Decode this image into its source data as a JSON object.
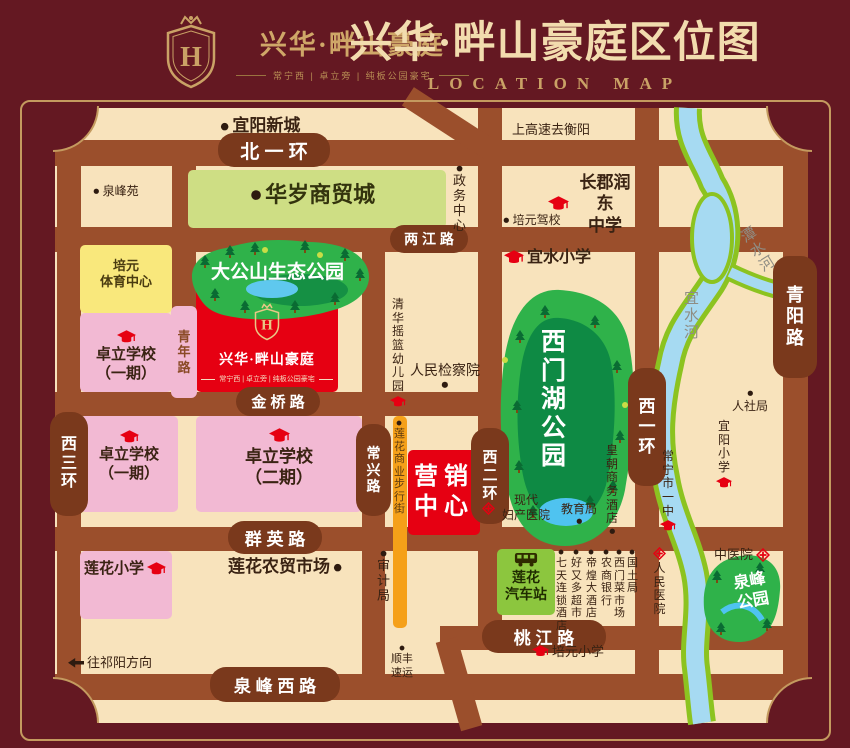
{
  "header": {
    "logo_name": "兴华·畔山豪庭",
    "logo_tagline": "常宁西 | 卓立旁 | 纯板公园豪宅",
    "title": "兴华·畔山豪庭区位图",
    "subtitle": "LOCATION MAP"
  },
  "colors": {
    "background_maroon": "#641822",
    "gold": "#c49a5f",
    "map_cream": "#f8e3bc",
    "road_brown": "#9b4f2c",
    "road_pill": "#7a391c",
    "school_pink": "#f2b9d3",
    "sports_yellow": "#f9e87c",
    "mall_green": "#cede84",
    "park_green": "#2fb24a",
    "park_dark_green": "#0e8a44",
    "river_blue": "#a6daf2",
    "bank_green": "#8cc320",
    "brand_red": "#e60012",
    "bus_green": "#8cc63e",
    "street_orange": "#f5a019"
  },
  "map": {
    "project": {
      "name": "兴华·畔山豪庭",
      "tagline": "常宁西 | 卓立旁 | 纯板公园豪宅"
    },
    "roads": [
      {
        "n": "beiyihuan",
        "x": 55,
        "y": 140,
        "w": 753,
        "h": 26
      },
      {
        "n": "liangjiang-rd",
        "x": 55,
        "y": 227,
        "w": 753,
        "h": 25
      },
      {
        "n": "jinqiao-rd",
        "x": 55,
        "y": 392,
        "w": 450,
        "h": 24
      },
      {
        "n": "qunying-rd",
        "x": 55,
        "y": 527,
        "w": 753,
        "h": 24
      },
      {
        "n": "taojiang-rd",
        "x": 440,
        "y": 626,
        "w": 368,
        "h": 24
      },
      {
        "n": "quanfeng-west-rd",
        "x": 55,
        "y": 674,
        "w": 753,
        "h": 26
      },
      {
        "n": "xisanhuan",
        "x": 57,
        "y": 108,
        "w": 24,
        "h": 615
      },
      {
        "n": "qingnian-rd",
        "x": 172,
        "y": 166,
        "w": 24,
        "h": 250
      },
      {
        "n": "changxing-rd",
        "x": 362,
        "y": 227,
        "w": 23,
        "h": 473
      },
      {
        "n": "xierhuan",
        "x": 478,
        "y": 108,
        "w": 24,
        "h": 522
      },
      {
        "n": "xiyihuan",
        "x": 635,
        "y": 108,
        "w": 24,
        "h": 592
      },
      {
        "n": "qingyang-rd",
        "x": 783,
        "y": 118,
        "w": 25,
        "h": 605
      },
      {
        "n": "xierhuan-ramp-top",
        "x": 400,
        "y": 112,
        "w": 98,
        "h": 22,
        "rot": 33
      },
      {
        "n": "xierhuan-ramp-bottom",
        "x": 448,
        "y": 638,
        "w": 22,
        "h": 92,
        "rot": -16
      }
    ],
    "road_labels": [
      {
        "n": "beiyihuan",
        "t": "北 一 环",
        "x": 218,
        "y": 133,
        "w": 112,
        "h": 34,
        "fs": 19
      },
      {
        "n": "liangjiang-rd",
        "t": "两 江 路",
        "x": 390,
        "y": 225,
        "w": 78,
        "h": 28,
        "fs": 14
      },
      {
        "n": "jinqiao-rd",
        "t": "金 桥 路",
        "x": 236,
        "y": 387,
        "w": 84,
        "h": 29,
        "fs": 15
      },
      {
        "n": "qunying-rd",
        "t": "群 英 路",
        "x": 228,
        "y": 521,
        "w": 94,
        "h": 33,
        "fs": 17
      },
      {
        "n": "taojiang-rd",
        "t": "桃 江 路",
        "x": 482,
        "y": 620,
        "w": 124,
        "h": 33,
        "fs": 17
      },
      {
        "n": "quanfeng-west-rd",
        "t": "泉 峰 西 路",
        "x": 210,
        "y": 667,
        "w": 130,
        "h": 35,
        "fs": 17
      },
      {
        "n": "xisanhuan",
        "t": "西三环",
        "x": 50,
        "y": 412,
        "w": 38,
        "h": 104,
        "fs": 16,
        "v": 1
      },
      {
        "n": "changxing-rd",
        "t": "常兴路",
        "x": 356,
        "y": 424,
        "w": 35,
        "h": 92,
        "fs": 14,
        "v": 1
      },
      {
        "n": "xierhuan",
        "t": "西二环",
        "x": 471,
        "y": 428,
        "w": 38,
        "h": 96,
        "fs": 15,
        "v": 1
      },
      {
        "n": "xiyihuan",
        "t": "西一环",
        "x": 628,
        "y": 368,
        "w": 38,
        "h": 118,
        "fs": 17,
        "v": 1
      },
      {
        "n": "qingyang-rd",
        "t": "青阳路",
        "x": 773,
        "y": 256,
        "w": 44,
        "h": 122,
        "fs": 18,
        "v": 1
      },
      {
        "n": "qingnian-rd",
        "t": "青年路",
        "x": 171,
        "y": 306,
        "w": 26,
        "h": 92,
        "fs": 13,
        "v": 1,
        "pink": 1
      }
    ],
    "blocks": [
      {
        "n": "huasui-mall",
        "x": 188,
        "y": 170,
        "w": 258,
        "h": 58,
        "bg": "#cede84"
      },
      {
        "n": "peiyuan-sports-center",
        "x": 80,
        "y": 245,
        "w": 92,
        "h": 68,
        "bg": "#f9e87c"
      },
      {
        "n": "zhuoli-school-1a",
        "x": 80,
        "y": 313,
        "w": 92,
        "h": 79,
        "bg": "#f2b9d3"
      },
      {
        "n": "zhuoli-school-1b",
        "x": 80,
        "y": 416,
        "w": 98,
        "h": 96,
        "bg": "#f2b9d3"
      },
      {
        "n": "zhuoli-school-2",
        "x": 196,
        "y": 416,
        "w": 166,
        "h": 96,
        "bg": "#f2b9d3"
      },
      {
        "n": "lianhua-primary",
        "x": 80,
        "y": 551,
        "w": 92,
        "h": 68,
        "bg": "#f2b9d3"
      },
      {
        "n": "project-site",
        "x": 196,
        "y": 262,
        "w": 142,
        "h": 130,
        "bg": "#e60012"
      },
      {
        "n": "sales-center",
        "x": 408,
        "y": 450,
        "w": 72,
        "h": 85,
        "bg": "#e60012"
      },
      {
        "n": "lianhua-bus-station",
        "x": 497,
        "y": 549,
        "w": 58,
        "h": 66,
        "bg": "#8cc63e"
      },
      {
        "n": "lianhua-walking-street",
        "x": 393,
        "y": 416,
        "w": 14,
        "h": 212,
        "bg": "#f5a019"
      }
    ],
    "pois": [
      {
        "n": "yiyang-new-town",
        "t": "宜阳新城",
        "x": 220,
        "y": 116,
        "fs": 17,
        "bold": 1,
        "icon": "dot",
        "ip": "left"
      },
      {
        "n": "highway-to-hengyang",
        "t": "上高速去衡阳",
        "x": 512,
        "y": 122,
        "fs": 13
      },
      {
        "n": "quanfengyuan",
        "t": "泉峰苑",
        "x": 93,
        "y": 184,
        "fs": 12,
        "icon": "dot",
        "ip": "left"
      },
      {
        "n": "government-center",
        "t": "政务中心",
        "x": 453,
        "y": 165,
        "fs": 13,
        "v": 1,
        "icon": "dot",
        "ip": "top"
      },
      {
        "n": "changjun-rundong-school",
        "lines": [
          "长郡润东",
          "中学"
        ],
        "x": 548,
        "y": 172,
        "w": 90,
        "fs": 17,
        "bold": 1,
        "icon": "cap",
        "ip": "left"
      },
      {
        "n": "peiyuan-driving-school",
        "t": "培元驾校",
        "x": 503,
        "y": 213,
        "fs": 12,
        "icon": "dot",
        "ip": "left"
      },
      {
        "n": "yishui-primary",
        "t": "宜水小学",
        "x": 504,
        "y": 248,
        "fs": 16,
        "bold": 1,
        "icon": "cap",
        "ip": "left"
      },
      {
        "n": "qinghua-cradle-kindergarten",
        "t": "清华摇篮幼儿园",
        "x": 390,
        "y": 298,
        "fs": 12,
        "v": 1,
        "icon": "cap",
        "ip": "bottom"
      },
      {
        "n": "peoples-procuratorate",
        "t": "人民检察院",
        "x": 410,
        "y": 362,
        "fs": 14,
        "icon": "dot",
        "ip": "bottom"
      },
      {
        "n": "tanshui-river-label",
        "t": "潭水河",
        "x": 737,
        "y": 228,
        "fs": 15,
        "v": 1,
        "rot": -32,
        "color": "#8f8d84"
      },
      {
        "n": "yishui-river-label",
        "t": "宜水河",
        "x": 684,
        "y": 290,
        "fs": 15,
        "v": 1,
        "color": "#8f8d84"
      },
      {
        "n": "social-security-bureau",
        "t": "人社局",
        "x": 732,
        "y": 390,
        "fs": 12,
        "icon": "dot",
        "ip": "top"
      },
      {
        "n": "yiyang-primary",
        "t": "宜阳小学",
        "x": 716,
        "y": 420,
        "fs": 12,
        "v": 1,
        "icon": "cap",
        "ip": "bottom"
      },
      {
        "n": "changning-no1-middle-school",
        "t": "常宁市一中",
        "x": 660,
        "y": 450,
        "fs": 12,
        "v": 1,
        "icon": "cap",
        "ip": "bottom"
      },
      {
        "n": "huangchao-business-hotel",
        "t": "皇朝商务酒店",
        "x": 606,
        "y": 444,
        "fs": 12,
        "v": 1,
        "icon": "dot",
        "ip": "bottom"
      },
      {
        "n": "modern-maternity-hospital",
        "lines": [
          "现代",
          "妇产医院"
        ],
        "x": 482,
        "y": 493,
        "w": 72,
        "fs": 12,
        "icon": "cross",
        "ip": "left"
      },
      {
        "n": "education-bureau",
        "t": "教育局",
        "x": 561,
        "y": 502,
        "fs": 12,
        "icon": "dot",
        "ip": "bottom"
      },
      {
        "n": "lianhua-walking-street-label",
        "t": "莲花商业步行街",
        "x": 394,
        "y": 420,
        "fs": 11,
        "v": 1,
        "icon": "dot",
        "ip": "top",
        "color": "#5c3a10"
      },
      {
        "n": "audit-bureau",
        "t": "审计局",
        "x": 377,
        "y": 550,
        "fs": 13,
        "v": 1,
        "icon": "dot",
        "ip": "top"
      },
      {
        "n": "lianhua-farmers-market",
        "t": "莲花农贸市场",
        "x": 228,
        "y": 557,
        "fs": 17,
        "bold": 1,
        "icon": "dot",
        "ip": "right"
      },
      {
        "n": "7days-inn",
        "t": "七天连锁酒店",
        "x": 556,
        "y": 549,
        "fs": 11,
        "v": 1,
        "icon": "dot",
        "ip": "top"
      },
      {
        "n": "haoyouduo-supermarket",
        "t": "好又多超市",
        "x": 571,
        "y": 549,
        "fs": 11,
        "v": 1,
        "icon": "dot",
        "ip": "top"
      },
      {
        "n": "dihuang-hotel",
        "t": "帝煌大酒店",
        "x": 586,
        "y": 549,
        "fs": 11,
        "v": 1,
        "icon": "dot",
        "ip": "top"
      },
      {
        "n": "rural-commercial-bank",
        "t": "农商银行",
        "x": 601,
        "y": 549,
        "fs": 11,
        "v": 1,
        "icon": "dot",
        "ip": "top"
      },
      {
        "n": "ximen-food-market",
        "t": "西门菜市场",
        "x": 614,
        "y": 549,
        "fs": 11,
        "v": 1,
        "icon": "dot",
        "ip": "top"
      },
      {
        "n": "land-resources-bureau",
        "t": "国土局",
        "x": 627,
        "y": 549,
        "fs": 11,
        "v": 1,
        "icon": "dot",
        "ip": "top"
      },
      {
        "n": "tcm-hospital",
        "t": "中医院",
        "x": 714,
        "y": 547,
        "fs": 13,
        "icon": "cross",
        "ip": "right"
      },
      {
        "n": "peoples-hospital",
        "t": "人民医院",
        "x": 653,
        "y": 547,
        "fs": 12,
        "v": 1,
        "icon": "cross",
        "ip": "top"
      },
      {
        "n": "sf-express",
        "lines": [
          "顺丰",
          "速运"
        ],
        "x": 382,
        "y": 645,
        "w": 40,
        "fs": 11,
        "icon": "dot",
        "ip": "top"
      },
      {
        "n": "to-qiyang-direction",
        "t": "往祁阳方向",
        "x": 68,
        "y": 655,
        "fs": 13,
        "icon": "arrow",
        "ip": "left"
      },
      {
        "n": "peiyuan-primary",
        "t": "培元小学",
        "x": 532,
        "y": 644,
        "fs": 13,
        "icon": "cap",
        "ip": "left"
      },
      {
        "n": "huasui-mall-label",
        "t": "华岁商贸城",
        "x": 250,
        "y": 182,
        "fs": 22,
        "bold": 1,
        "icon": "dot",
        "ip": "left",
        "color": "#33330d"
      },
      {
        "n": "peiyuan-sports-label",
        "lines": [
          "培元",
          "体育中心"
        ],
        "x": 84,
        "y": 258,
        "w": 84,
        "fs": 13,
        "bold": 1,
        "color": "#4a3b10"
      },
      {
        "n": "zhuoli-school-1a-label",
        "lines": [
          "卓立学校",
          "（一期）"
        ],
        "x": 84,
        "y": 330,
        "w": 84,
        "fs": 15,
        "bold": 1,
        "icon": "cap",
        "ip": "top"
      },
      {
        "n": "zhuoli-school-1b-label",
        "lines": [
          "卓立学校",
          "（一期）"
        ],
        "x": 84,
        "y": 430,
        "w": 90,
        "fs": 15,
        "bold": 1,
        "icon": "cap",
        "ip": "top"
      },
      {
        "n": "zhuoli-school-2-label",
        "lines": [
          "卓立学校",
          "（二期）"
        ],
        "x": 216,
        "y": 428,
        "w": 126,
        "fs": 17,
        "bold": 1,
        "icon": "cap",
        "ip": "top"
      },
      {
        "n": "lianhua-primary-label",
        "t": "莲花小学",
        "x": 84,
        "y": 560,
        "fs": 15,
        "bold": 1,
        "icon": "cap",
        "ip": "right"
      },
      {
        "n": "sales-center-label",
        "lines": [
          "营销",
          "中心"
        ],
        "x": 408,
        "y": 462,
        "w": 72,
        "fs": 24,
        "bold": 1,
        "color": "#ffffff",
        "ls": 6
      },
      {
        "n": "lianhua-bus-station-label",
        "lines": [
          "莲花",
          "汽车站"
        ],
        "x": 499,
        "y": 552,
        "w": 54,
        "fs": 14,
        "bold": 1,
        "icon": "bus",
        "ip": "top",
        "color": "#1f2a00"
      },
      {
        "n": "dagongshan-park-label",
        "t": "大公山生态公园",
        "x": 211,
        "y": 262,
        "fs": 19,
        "bold": 1,
        "color": "#ffffff"
      },
      {
        "n": "ximenhu-park-label",
        "t": "西门湖公园",
        "x": 541,
        "y": 328,
        "fs": 25,
        "v": 1,
        "bold": 1,
        "color": "#ffffff"
      },
      {
        "n": "quanfeng-park-label",
        "lines": [
          "泉峰",
          "公园"
        ],
        "x": 720,
        "y": 572,
        "w": 56,
        "fs": 16,
        "bold": 1,
        "color": "#ffffff",
        "rot": -10
      }
    ]
  }
}
